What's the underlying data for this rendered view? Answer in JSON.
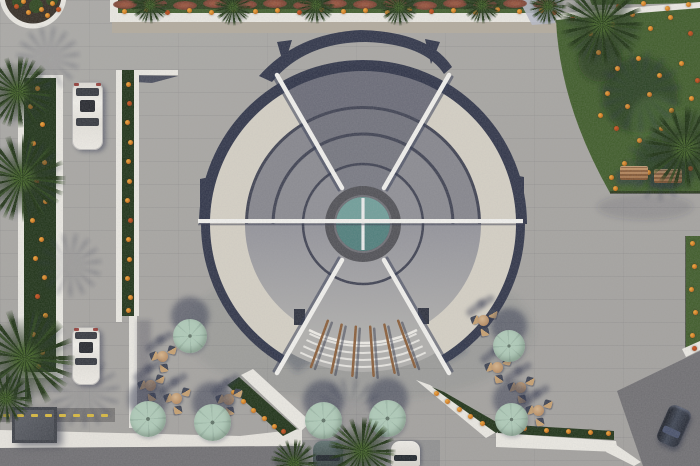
{
  "meta": {
    "title": "Aerial architectural render: circular tiered-roof pavilion with central skylight, entry steps, cafe umbrellas, parking lanes, palm trees and flower gardens",
    "width": 700,
    "height": 466
  },
  "palette": {
    "pavement": "#a7a5a1",
    "plazaTint": "rgba(80,84,100,0.10)",
    "road": "#6f6e71",
    "white": "#eceae3",
    "cream": "#d6d1c5",
    "navy": "#2e3347",
    "sep": "#3d4050",
    "g1": "#8f8f95",
    "g2": "#8a8a90",
    "g3": "#85858c",
    "g4": "#7b7c86",
    "lowerTop": "#93939a",
    "lowerBottom": "#b2b1ae",
    "steps": "#b1b0ad",
    "ring": "#4f4f54",
    "glassLight": "#6f9e99",
    "glassDark": "#4e7e7b",
    "grass": "#3d5a27",
    "grassDark": "#243d15",
    "hedge": "#1d3115",
    "flower": "#e08a1e",
    "shrub": "#8a4a35",
    "gravel": "#b3ab9d",
    "umbA": "#b0ccb9",
    "umbB": "#a0bcaa",
    "wood": "#8a5c36",
    "tan": "#c8a37a",
    "carWhite": "#eceae4",
    "carDark": "#232834",
    "carTeal": "#4c5e5c",
    "kiosk": "#3e4148",
    "yellow": "#d8b83c",
    "bluePatch": "#b7bac6",
    "shadow": "rgba(42,48,72,0.45)"
  },
  "objects": {
    "umbrellas": [
      [
        190,
        336,
        34
      ],
      [
        148,
        419,
        36
      ],
      [
        212,
        422,
        37
      ],
      [
        323,
        420,
        37
      ],
      [
        387,
        418,
        37
      ],
      [
        509,
        346,
        32
      ],
      [
        511,
        419,
        33
      ]
    ],
    "seating": [
      [
        162,
        356
      ],
      [
        176,
        398
      ],
      [
        228,
        399
      ],
      [
        150,
        385
      ],
      [
        497,
        367
      ],
      [
        520,
        387
      ],
      [
        538,
        410
      ],
      [
        483,
        320
      ]
    ],
    "mainPalms": [
      [
        18,
        92,
        36
      ],
      [
        22,
        178,
        44
      ],
      [
        25,
        358,
        50
      ],
      [
        6,
        398,
        26
      ],
      [
        602,
        24,
        42
      ],
      [
        685,
        148,
        42
      ],
      [
        362,
        451,
        34
      ],
      [
        294,
        463,
        24
      ]
    ],
    "bedPalms": [
      [
        150,
        5
      ],
      [
        233,
        7
      ],
      [
        316,
        5
      ],
      [
        399,
        7
      ],
      [
        482,
        5
      ],
      [
        548,
        6
      ]
    ],
    "palmShadows": [
      [
        48,
        58,
        34
      ],
      [
        70,
        265,
        34
      ],
      [
        84,
        392,
        38
      ],
      [
        350,
        412,
        36
      ],
      [
        640,
        92,
        44
      ],
      [
        660,
        165,
        38
      ]
    ],
    "carsWhite": [
      [
        72,
        82,
        31,
        68
      ],
      [
        72,
        327,
        28,
        58
      ]
    ],
    "carsBottom": [
      [
        313,
        441,
        30,
        25,
        "teal"
      ],
      [
        391,
        441,
        29,
        25,
        "white"
      ]
    ],
    "carDark": [
      662,
      406,
      24,
      40,
      24
    ],
    "benches": [
      [
        620,
        166
      ],
      [
        654,
        169
      ]
    ],
    "kiosk": [
      12,
      407,
      45,
      36
    ],
    "speedBumpDashes": {
      "y": 414,
      "xs": [
        3,
        17,
        31,
        45,
        59,
        73,
        87,
        101
      ]
    },
    "shrubs": [
      [
        125,
        4
      ],
      [
        155,
        3
      ],
      [
        185,
        5
      ],
      [
        215,
        3
      ],
      [
        245,
        4
      ],
      [
        275,
        3
      ],
      [
        305,
        5
      ],
      [
        335,
        3
      ],
      [
        365,
        4
      ],
      [
        395,
        3
      ],
      [
        425,
        5
      ],
      [
        455,
        3
      ],
      [
        485,
        4
      ],
      [
        515,
        3
      ],
      [
        545,
        4
      ]
    ],
    "flowers": {
      "garden": [
        [
          572,
          18
        ],
        [
          590,
          33
        ],
        [
          612,
          24
        ],
        [
          632,
          14
        ],
        [
          650,
          28
        ],
        [
          670,
          17
        ],
        [
          690,
          33
        ],
        [
          598,
          52
        ],
        [
          617,
          68
        ],
        [
          638,
          58
        ],
        [
          659,
          75
        ],
        [
          681,
          63
        ],
        [
          697,
          80
        ],
        [
          607,
          93
        ],
        [
          627,
          106
        ],
        [
          649,
          94
        ],
        [
          671,
          110
        ],
        [
          691,
          98
        ],
        [
          616,
          128
        ],
        [
          639,
          140
        ],
        [
          661,
          128
        ],
        [
          683,
          146
        ],
        [
          624,
          163
        ],
        [
          648,
          172
        ],
        [
          690,
          168
        ],
        [
          600,
          115
        ],
        [
          611,
          177
        ],
        [
          615,
          188
        ]
      ],
      "bed": [
        [
          124,
          11
        ],
        [
          146,
          9
        ],
        [
          167,
          12
        ],
        [
          189,
          10
        ],
        [
          211,
          12
        ],
        [
          233,
          9
        ],
        [
          255,
          11
        ],
        [
          277,
          10
        ],
        [
          299,
          12
        ],
        [
          321,
          9
        ],
        [
          343,
          11
        ],
        [
          365,
          10
        ],
        [
          387,
          12
        ],
        [
          409,
          9
        ],
        [
          431,
          11
        ],
        [
          453,
          10
        ],
        [
          475,
          12
        ],
        [
          497,
          9
        ],
        [
          519,
          11
        ],
        [
          541,
          10
        ],
        [
          554,
          12
        ]
      ],
      "leftHedge": [
        [
          37,
          88
        ],
        [
          30,
          106
        ],
        [
          42,
          124
        ],
        [
          33,
          143
        ],
        [
          44,
          162
        ],
        [
          36,
          181
        ],
        [
          45,
          201
        ],
        [
          32,
          220
        ],
        [
          41,
          239
        ],
        [
          35,
          258
        ],
        [
          44,
          277
        ],
        [
          37,
          296
        ],
        [
          45,
          315
        ],
        [
          33,
          334
        ],
        [
          42,
          352
        ],
        [
          38,
          366
        ]
      ],
      "thinStrip": [
        [
          128,
          84
        ],
        [
          129,
          103
        ],
        [
          127,
          122
        ],
        [
          130,
          142
        ],
        [
          128,
          161
        ],
        [
          129,
          181
        ],
        [
          127,
          200
        ],
        [
          130,
          220
        ],
        [
          128,
          239
        ],
        [
          129,
          259
        ],
        [
          127,
          278
        ],
        [
          130,
          297
        ],
        [
          128,
          310
        ]
      ],
      "circlePlanter": [
        [
          16,
          6
        ],
        [
          28,
          12
        ],
        [
          41,
          9
        ],
        [
          52,
          3
        ],
        [
          23,
          1
        ],
        [
          47,
          15
        ],
        [
          58,
          9
        ]
      ],
      "rightStrip": [
        [
          692,
          243
        ],
        [
          694,
          266
        ],
        [
          691,
          289
        ],
        [
          695,
          312
        ],
        [
          692,
          335
        ],
        [
          694,
          348
        ]
      ],
      "bottomLeftHedge": [
        [
          233,
          392
        ],
        [
          243,
          401
        ],
        [
          253,
          410
        ],
        [
          264,
          418
        ],
        [
          274,
          426
        ],
        [
          283,
          431
        ]
      ],
      "bottomRightHedge": [
        [
          436,
          393
        ],
        [
          447,
          401
        ],
        [
          459,
          409
        ],
        [
          470,
          416
        ],
        [
          482,
          423
        ],
        [
          502,
          426
        ],
        [
          524,
          428
        ],
        [
          546,
          430
        ],
        [
          568,
          431
        ],
        [
          590,
          432
        ],
        [
          608,
          433
        ]
      ],
      "topRightGrass": [
        [
          618,
          6
        ],
        [
          643,
          3
        ],
        [
          667,
          8
        ],
        [
          688,
          4
        ]
      ]
    }
  }
}
